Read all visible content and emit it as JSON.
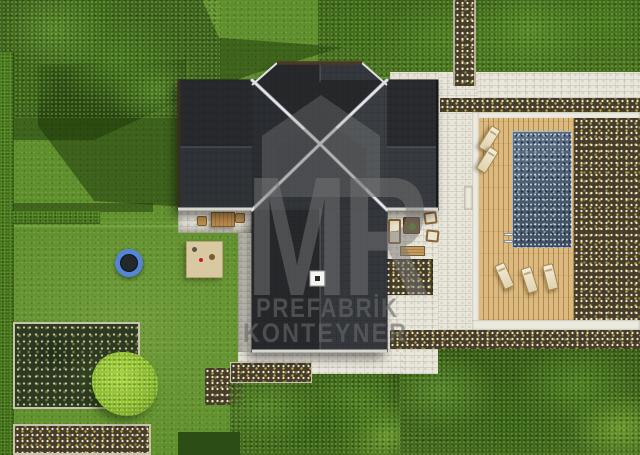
{
  "watermark": {
    "logo": "MR",
    "line1": "PREFABRİK",
    "line2": "KONTEYNER"
  },
  "scene": {
    "type": "aerial-3d-render",
    "subject": "top-down site plan render of a prefabricated house",
    "objects": [
      "cross-shaped hip roof with white chimney",
      "rectangular swimming pool",
      "wooden pool deck",
      "5 sun loungers",
      "outdoor sofa, two armchairs, coffee table and bench",
      "dining table with two stools",
      "children's play mat with toys",
      "blue trampoline",
      "stone paver patios and paths",
      "flower beds and soil strips",
      "hedges along left boundary",
      "trees and shrubs",
      "lawn"
    ]
  },
  "colors": {
    "c-lawn": "#5f8f2c",
    "c-tree-mid": "#55842a",
    "c-tree-bright": "#a4d13d",
    "c-hedge": "#4a7b1e",
    "c-soil": "#463d2b",
    "c-paver": "#e9e6dc",
    "c-deck": "#dcb97e",
    "c-pool": "#53667a",
    "c-cushion": "#f2ecd9",
    "c-wood": "#bb904f",
    "c-mat": "#d9c9a2",
    "c-tramp": "#5585d8",
    "c-roof-dark": "#26282b",
    "c-roof-light": "#3a3e42",
    "c-ridge": "#e3e6e8",
    "c-gutter": "#4c3729"
  }
}
